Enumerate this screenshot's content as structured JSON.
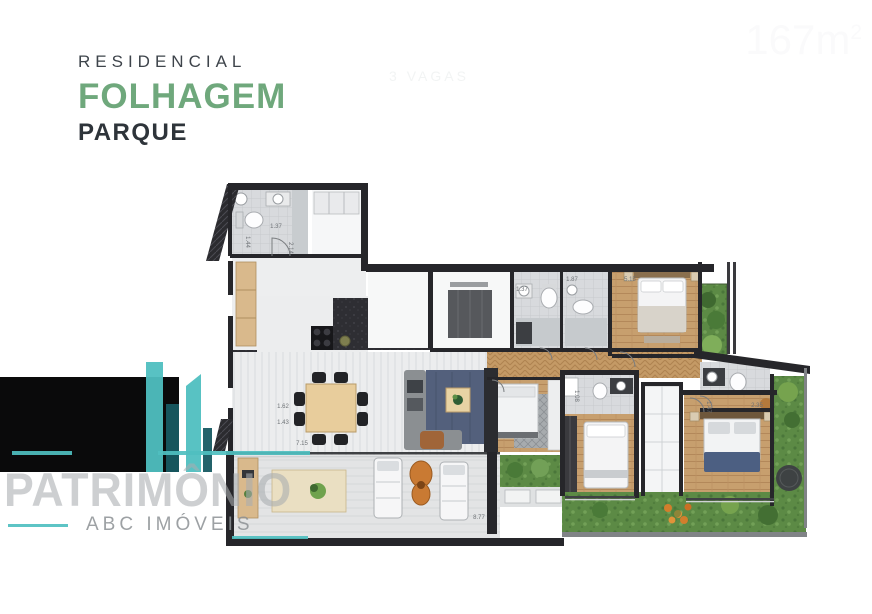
{
  "brand": {
    "line1": "RESIDENCIAL",
    "line2": "FOLHAGEM",
    "line3": "PARQUE",
    "green": "#6FA87C",
    "ink": "#2E343A"
  },
  "badge": {
    "area_value": "167",
    "area_unit": "m",
    "area_sup": "2",
    "vagas": "3 VAGAS",
    "bg": "#0A0A0B",
    "accent": "#4FBFC0"
  },
  "watermark": {
    "name": "PATRIMÔNIO",
    "tagline": "ABC IMÓVEIS",
    "accent": "#4FBFC0"
  },
  "floor_plan": {
    "type": "apartment floor plan, hand-rendered style",
    "palette": {
      "wall": "#26262A",
      "wood": "#C79F6E",
      "grass": "#5C8A45",
      "navy_rug": "#53607C",
      "tile": "#D8DADD",
      "terrace": "#E3E4E5",
      "orange": "#C97A33"
    },
    "dimensions": [
      {
        "label": "1.37",
        "x": 276,
        "y": 228,
        "rot": 0
      },
      {
        "label": "2.14",
        "x": 289,
        "y": 248,
        "rot": 90
      },
      {
        "label": "1.44",
        "x": 246,
        "y": 242,
        "rot": 90
      },
      {
        "label": "1.62",
        "x": 283,
        "y": 408,
        "rot": 0
      },
      {
        "label": "1.43",
        "x": 283,
        "y": 424,
        "rot": 0
      },
      {
        "label": "7.15",
        "x": 302,
        "y": 445,
        "rot": 0
      },
      {
        "label": "5.15",
        "x": 630,
        "y": 281,
        "rot": 0
      },
      {
        "label": "1.87",
        "x": 572,
        "y": 281,
        "rot": 0
      },
      {
        "label": "1.37",
        "x": 522,
        "y": 291,
        "rot": 0
      },
      {
        "label": "1.08",
        "x": 575,
        "y": 396,
        "rot": 90
      },
      {
        "label": "2.35",
        "x": 757,
        "y": 407,
        "rot": 0
      },
      {
        "label": "1.47",
        "x": 707,
        "y": 407,
        "rot": 90
      },
      {
        "label": "8.77",
        "x": 479,
        "y": 519,
        "rot": 0
      }
    ]
  }
}
